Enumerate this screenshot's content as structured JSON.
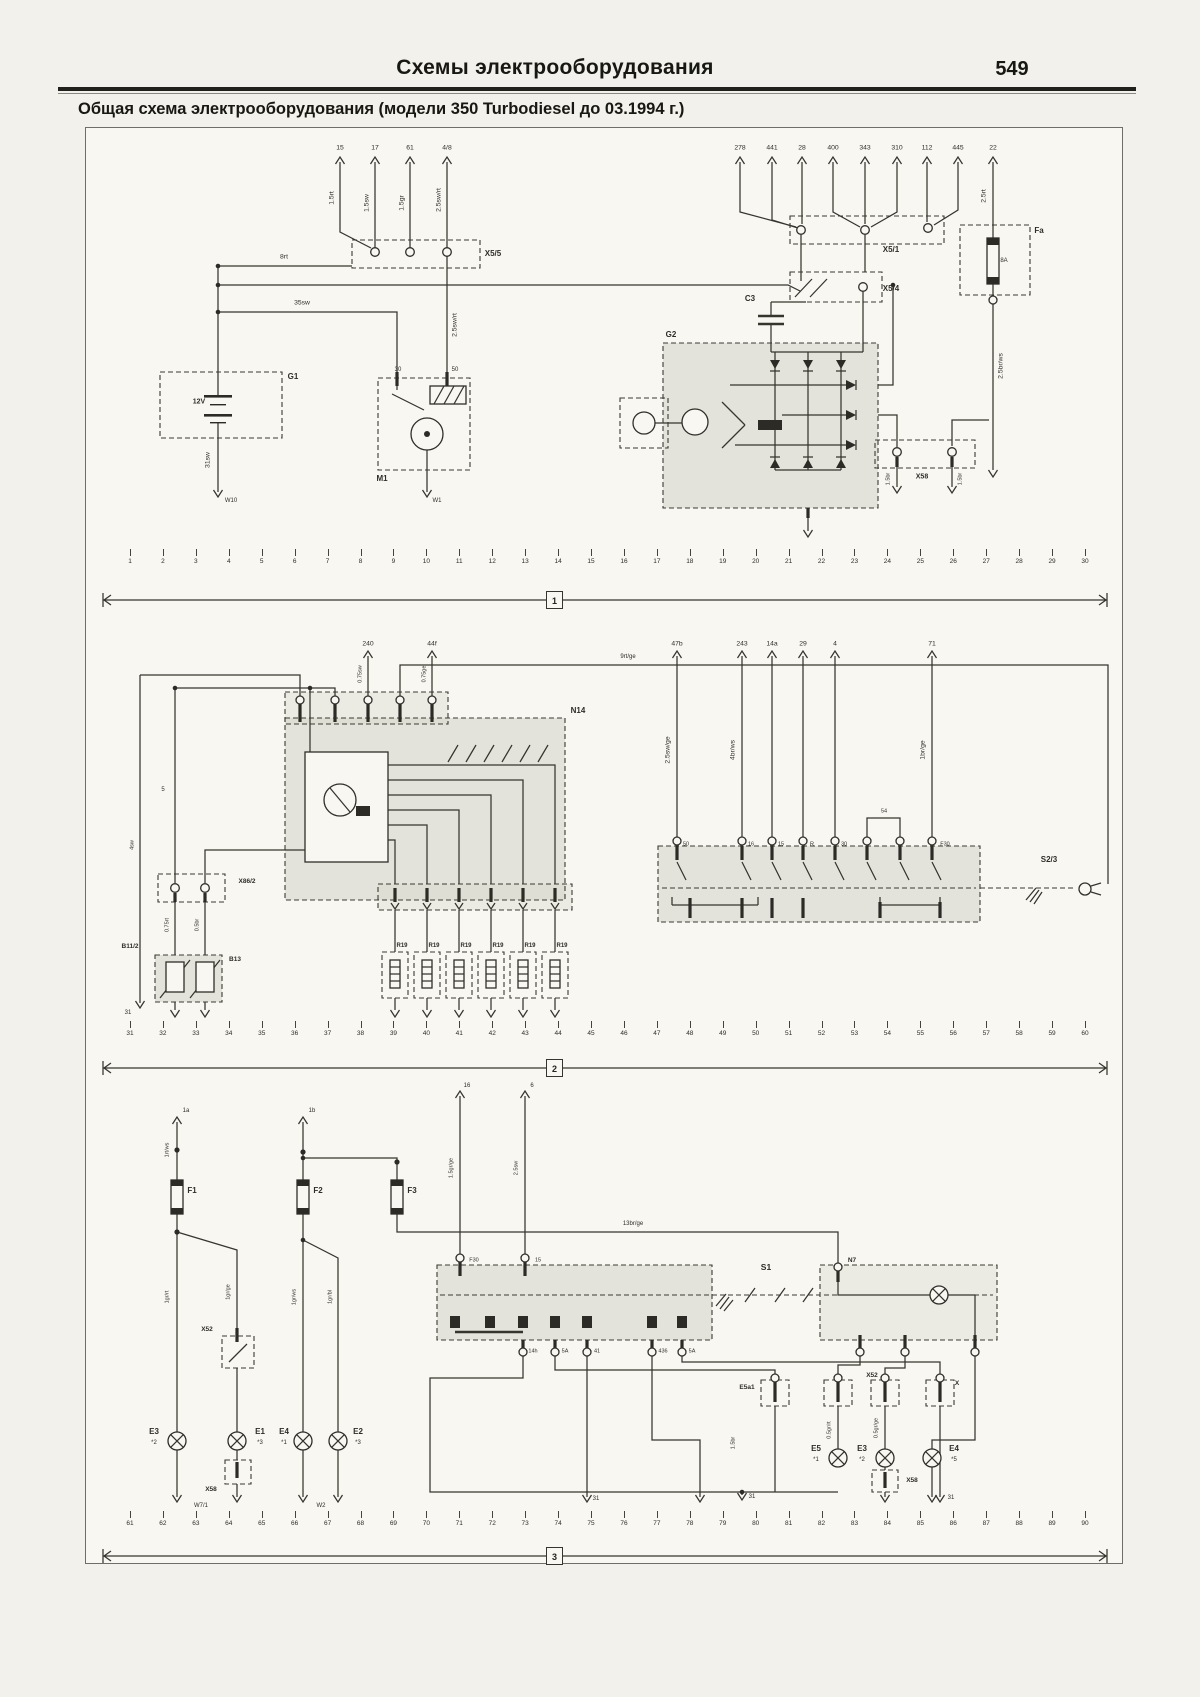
{
  "page": {
    "title": "Схемы электрооборудования",
    "page_number": "549",
    "subtitle": "Общая схема электрооборудования (модели 350 Turbodiesel до 03.1994 г.)"
  },
  "sections": [
    {
      "marker": "1"
    },
    {
      "marker": "2"
    },
    {
      "marker": "3"
    }
  ],
  "bus_strips": {
    "bus1": [
      "1",
      "2",
      "3",
      "4",
      "5",
      "6",
      "7",
      "8",
      "9",
      "10",
      "11",
      "12",
      "13",
      "14",
      "15",
      "16",
      "17",
      "18",
      "19",
      "20",
      "21",
      "22",
      "23",
      "24",
      "25",
      "26",
      "27",
      "28",
      "29",
      "30"
    ],
    "bus2": [
      "31",
      "32",
      "33",
      "34",
      "35",
      "36",
      "37",
      "38",
      "39",
      "40",
      "41",
      "42",
      "43",
      "44",
      "45",
      "46",
      "47",
      "48",
      "49",
      "50",
      "51",
      "52",
      "53",
      "54",
      "55",
      "56",
      "57",
      "58",
      "59",
      "60"
    ],
    "bus3": [
      "61",
      "62",
      "63",
      "64",
      "65",
      "66",
      "67",
      "68",
      "69",
      "70",
      "71",
      "72",
      "73",
      "74",
      "75",
      "76",
      "77",
      "78",
      "79",
      "80",
      "81",
      "82",
      "83",
      "84",
      "85",
      "86",
      "87",
      "88",
      "89",
      "90"
    ]
  },
  "diagram": {
    "labels": [
      {
        "n": "ref",
        "t": "15",
        "x": 340,
        "y": 149
      },
      {
        "n": "ref",
        "t": "17",
        "x": 375,
        "y": 149
      },
      {
        "n": "ref",
        "t": "61",
        "x": 410,
        "y": 149
      },
      {
        "n": "ref",
        "t": "4/8",
        "x": 447,
        "y": 149
      },
      {
        "n": "wire",
        "t": "1.5rt",
        "x": 333,
        "y": 198,
        "r": 1
      },
      {
        "n": "wire",
        "t": "1.5sw",
        "x": 368,
        "y": 203,
        "r": 1
      },
      {
        "n": "wire",
        "t": "1.5gr",
        "x": 403,
        "y": 203,
        "r": 1
      },
      {
        "n": "wire",
        "t": "2.5sw/rt",
        "x": 440,
        "y": 200,
        "r": 1
      },
      {
        "n": "comp",
        "t": "X5/5",
        "x": 493,
        "y": 254,
        "b": 1
      },
      {
        "n": "wire",
        "t": "8rt",
        "x": 284,
        "y": 258
      },
      {
        "n": "wire",
        "t": "35sw",
        "x": 302,
        "y": 304
      },
      {
        "n": "wire",
        "t": "2.5sw/rt",
        "x": 456,
        "y": 325,
        "r": 1
      },
      {
        "n": "comp",
        "t": "G1",
        "x": 293,
        "y": 377,
        "b": 1
      },
      {
        "t": "12V",
        "x": 199,
        "y": 402,
        "b": 1,
        "s": 7
      },
      {
        "n": "wire",
        "t": "31sw",
        "x": 209,
        "y": 460,
        "r": 1
      },
      {
        "n": "ground",
        "t": "W10",
        "x": 231,
        "y": 501,
        "s": 6
      },
      {
        "n": "pin",
        "t": "30",
        "x": 398,
        "y": 370,
        "s": 6
      },
      {
        "n": "pin",
        "t": "50",
        "x": 455,
        "y": 370,
        "s": 6
      },
      {
        "n": "comp",
        "t": "M1",
        "x": 382,
        "y": 479,
        "b": 1
      },
      {
        "n": "ground",
        "t": "W1",
        "x": 437,
        "y": 501,
        "s": 6
      },
      {
        "n": "ref",
        "t": "278",
        "x": 740,
        "y": 149
      },
      {
        "n": "ref",
        "t": "441",
        "x": 772,
        "y": 149
      },
      {
        "n": "ref",
        "t": "28",
        "x": 802,
        "y": 149
      },
      {
        "n": "ref",
        "t": "400",
        "x": 833,
        "y": 149
      },
      {
        "n": "ref",
        "t": "343",
        "x": 865,
        "y": 149
      },
      {
        "n": "ref",
        "t": "310",
        "x": 897,
        "y": 149
      },
      {
        "n": "ref",
        "t": "112",
        "x": 927,
        "y": 149
      },
      {
        "n": "ref",
        "t": "445",
        "x": 958,
        "y": 149
      },
      {
        "n": "ref",
        "t": "22",
        "x": 993,
        "y": 149
      },
      {
        "n": "wire",
        "t": "2.5rt",
        "x": 985,
        "y": 196,
        "r": 1
      },
      {
        "n": "comp",
        "t": "X5/1",
        "x": 891,
        "y": 250,
        "b": 1
      },
      {
        "n": "comp",
        "t": "X5/4",
        "x": 891,
        "y": 289,
        "b": 1
      },
      {
        "n": "comp",
        "t": "Fa",
        "x": 1039,
        "y": 231,
        "b": 1
      },
      {
        "t": "8A",
        "x": 1004,
        "y": 261,
        "s": 6
      },
      {
        "n": "wire",
        "t": "2.5br/ws",
        "x": 1002,
        "y": 366,
        "r": 1
      },
      {
        "n": "comp",
        "t": "C3",
        "x": 750,
        "y": 299,
        "b": 1
      },
      {
        "n": "comp",
        "t": "G2",
        "x": 671,
        "y": 335,
        "b": 1
      },
      {
        "n": "comp",
        "t": "X58",
        "x": 922,
        "y": 477,
        "b": 1,
        "s": 7
      },
      {
        "n": "wire",
        "t": "1.5br",
        "x": 889,
        "y": 479,
        "r": 1,
        "s": 5.5
      },
      {
        "n": "wire",
        "t": "1.5br",
        "x": 961,
        "y": 479,
        "r": 1,
        "s": 5.5
      },
      {
        "n": "ref",
        "t": "240",
        "x": 368,
        "y": 645
      },
      {
        "n": "ref",
        "t": "44f",
        "x": 432,
        "y": 645
      },
      {
        "n": "wire",
        "t": "0.75sw",
        "x": 361,
        "y": 674,
        "r": 1,
        "s": 5.5
      },
      {
        "n": "wire",
        "t": "0.75ge",
        "x": 425,
        "y": 674,
        "r": 1,
        "s": 5.5
      },
      {
        "n": "wire",
        "t": "9rt/ge",
        "x": 628,
        "y": 657,
        "s": 6
      },
      {
        "n": "comp",
        "t": "N14",
        "x": 578,
        "y": 711,
        "b": 1
      },
      {
        "t": "5",
        "x": 163,
        "y": 790,
        "s": 6
      },
      {
        "n": "wire",
        "t": "4sw",
        "x": 133,
        "y": 845,
        "r": 1,
        "s": 5.5
      },
      {
        "n": "comp",
        "t": "X86/2",
        "x": 247,
        "y": 882,
        "b": 1,
        "s": 6.5
      },
      {
        "n": "wire",
        "t": "0.75rt",
        "x": 168,
        "y": 925,
        "r": 1,
        "s": 5.5
      },
      {
        "n": "wire",
        "t": "0.5br",
        "x": 198,
        "y": 925,
        "r": 1,
        "s": 5.5
      },
      {
        "n": "comp",
        "t": "B11/2",
        "x": 130,
        "y": 947,
        "b": 1,
        "s": 6.5
      },
      {
        "n": "comp",
        "t": "B13",
        "x": 235,
        "y": 960,
        "b": 1,
        "s": 6.5
      },
      {
        "n": "ground",
        "t": "31",
        "x": 128,
        "y": 1013,
        "s": 6
      },
      {
        "n": "comp",
        "t": "R19",
        "x": 402,
        "y": 946,
        "b": 1,
        "s": 6
      },
      {
        "n": "comp",
        "t": "R19",
        "x": 434,
        "y": 946,
        "b": 1,
        "s": 6
      },
      {
        "n": "comp",
        "t": "R19",
        "x": 466,
        "y": 946,
        "b": 1,
        "s": 6
      },
      {
        "n": "comp",
        "t": "R19",
        "x": 498,
        "y": 946,
        "b": 1,
        "s": 6
      },
      {
        "n": "comp",
        "t": "R19",
        "x": 530,
        "y": 946,
        "b": 1,
        "s": 6
      },
      {
        "n": "comp",
        "t": "R19",
        "x": 562,
        "y": 946,
        "b": 1,
        "s": 6
      },
      {
        "n": "ref",
        "t": "47b",
        "x": 677,
        "y": 645
      },
      {
        "n": "ref",
        "t": "243",
        "x": 742,
        "y": 645
      },
      {
        "n": "ref",
        "t": "14a",
        "x": 772,
        "y": 645
      },
      {
        "n": "ref",
        "t": "29",
        "x": 803,
        "y": 645
      },
      {
        "n": "ref",
        "t": "4",
        "x": 835,
        "y": 645
      },
      {
        "n": "ref",
        "t": "71",
        "x": 932,
        "y": 645
      },
      {
        "n": "wire",
        "t": "2.5sw/ge",
        "x": 669,
        "y": 750,
        "r": 1
      },
      {
        "n": "wire",
        "t": "4br/ws",
        "x": 734,
        "y": 750,
        "r": 1
      },
      {
        "n": "wire",
        "t": "1br/ge",
        "x": 924,
        "y": 750,
        "r": 1
      },
      {
        "t": "54",
        "x": 884,
        "y": 812,
        "s": 5.5
      },
      {
        "n": "pin",
        "t": "50",
        "x": 686,
        "y": 845,
        "s": 5.5
      },
      {
        "n": "pin",
        "t": "16",
        "x": 751,
        "y": 845,
        "s": 5.5
      },
      {
        "n": "pin",
        "t": "15",
        "x": 781,
        "y": 845,
        "s": 5.5
      },
      {
        "n": "pin",
        "t": "R",
        "x": 812,
        "y": 845,
        "s": 5.5
      },
      {
        "n": "pin",
        "t": "30",
        "x": 844,
        "y": 845,
        "s": 5.5
      },
      {
        "n": "pin",
        "t": "F30",
        "x": 945,
        "y": 845,
        "s": 5.5
      },
      {
        "n": "comp",
        "t": "S2/3",
        "x": 1049,
        "y": 860,
        "b": 1
      },
      {
        "n": "ref",
        "t": "1a",
        "x": 186,
        "y": 1111,
        "s": 6
      },
      {
        "n": "ref",
        "t": "1b",
        "x": 312,
        "y": 1111,
        "s": 6
      },
      {
        "n": "ref",
        "t": "16",
        "x": 467,
        "y": 1086,
        "s": 6
      },
      {
        "n": "ref",
        "t": "6",
        "x": 532,
        "y": 1086,
        "s": 6
      },
      {
        "n": "wire",
        "t": "1rt/ws",
        "x": 168,
        "y": 1150,
        "r": 1,
        "s": 5.5
      },
      {
        "n": "comp",
        "t": "F1",
        "x": 192,
        "y": 1191,
        "b": 1
      },
      {
        "n": "comp",
        "t": "F2",
        "x": 318,
        "y": 1191,
        "b": 1
      },
      {
        "n": "comp",
        "t": "F3",
        "x": 412,
        "y": 1191,
        "b": 1
      },
      {
        "n": "wire",
        "t": "1gr/rt",
        "x": 168,
        "y": 1297,
        "r": 1,
        "s": 5.5
      },
      {
        "n": "wire",
        "t": "1gr/ge",
        "x": 229,
        "y": 1292,
        "r": 1,
        "s": 5.5
      },
      {
        "n": "wire",
        "t": "1gr/ws",
        "x": 295,
        "y": 1297,
        "r": 1,
        "s": 5.5
      },
      {
        "n": "wire",
        "t": "1gr/bl",
        "x": 331,
        "y": 1297,
        "r": 1,
        "s": 5.5
      },
      {
        "n": "wire",
        "t": "1.5gr/ge",
        "x": 452,
        "y": 1168,
        "r": 1,
        "s": 5.5
      },
      {
        "n": "wire",
        "t": "2.5sw",
        "x": 517,
        "y": 1168,
        "r": 1,
        "s": 5.5
      },
      {
        "n": "wire",
        "t": "13br/ge",
        "x": 633,
        "y": 1224,
        "s": 6
      },
      {
        "n": "pin",
        "t": "N7",
        "x": 852,
        "y": 1261,
        "b": 1,
        "s": 6.5
      },
      {
        "n": "comp",
        "t": "S1",
        "x": 766,
        "y": 1267,
        "b": 1,
        "s": 8.5
      },
      {
        "n": "pin",
        "t": "F30",
        "x": 474,
        "y": 1261,
        "s": 5.5
      },
      {
        "n": "pin",
        "t": "15",
        "x": 538,
        "y": 1261,
        "s": 5.5
      },
      {
        "n": "pin",
        "t": "14h",
        "x": 533,
        "y": 1352,
        "s": 5.5
      },
      {
        "n": "pin",
        "t": "5A",
        "x": 565,
        "y": 1352,
        "s": 5.5
      },
      {
        "n": "pin",
        "t": "41",
        "x": 597,
        "y": 1352,
        "s": 5.5
      },
      {
        "n": "pin",
        "t": "436",
        "x": 663,
        "y": 1352,
        "s": 5.5
      },
      {
        "n": "pin",
        "t": "5A",
        "x": 692,
        "y": 1352,
        "s": 5.5
      },
      {
        "n": "comp",
        "t": "X52",
        "x": 207,
        "y": 1330,
        "b": 1,
        "s": 6.5
      },
      {
        "n": "comp",
        "t": "X58",
        "x": 211,
        "y": 1490,
        "b": 1,
        "s": 6.5
      },
      {
        "n": "comp",
        "t": "E3",
        "x": 154,
        "y": 1432,
        "b": 1
      },
      {
        "t": "*2",
        "x": 154,
        "y": 1443,
        "s": 6
      },
      {
        "n": "comp",
        "t": "E1",
        "x": 260,
        "y": 1432,
        "b": 1
      },
      {
        "t": "*3",
        "x": 260,
        "y": 1443,
        "s": 6
      },
      {
        "n": "comp",
        "t": "E4",
        "x": 284,
        "y": 1432,
        "b": 1
      },
      {
        "t": "*1",
        "x": 284,
        "y": 1443,
        "s": 6
      },
      {
        "n": "comp",
        "t": "E2",
        "x": 358,
        "y": 1432,
        "b": 1
      },
      {
        "t": "*3",
        "x": 358,
        "y": 1443,
        "s": 6
      },
      {
        "n": "ground",
        "t": "W7/1",
        "x": 201,
        "y": 1506,
        "s": 6
      },
      {
        "n": "ground",
        "t": "W2",
        "x": 321,
        "y": 1506,
        "s": 6
      },
      {
        "n": "comp",
        "t": "E5a1",
        "x": 747,
        "y": 1388,
        "b": 1,
        "s": 6.5
      },
      {
        "n": "comp",
        "t": "X52",
        "x": 872,
        "y": 1376,
        "b": 1,
        "s": 6.5
      },
      {
        "n": "comp",
        "t": "X",
        "x": 957,
        "y": 1384,
        "b": 1,
        "s": 6.5
      },
      {
        "n": "comp",
        "t": "X58",
        "x": 912,
        "y": 1481,
        "b": 1,
        "s": 6.5
      },
      {
        "n": "comp",
        "t": "E5",
        "x": 816,
        "y": 1449,
        "b": 1
      },
      {
        "t": "*1",
        "x": 816,
        "y": 1460,
        "s": 6
      },
      {
        "n": "comp",
        "t": "E3",
        "x": 862,
        "y": 1449,
        "b": 1
      },
      {
        "t": "*2",
        "x": 862,
        "y": 1460,
        "s": 6
      },
      {
        "n": "comp",
        "t": "E4",
        "x": 954,
        "y": 1449,
        "b": 1
      },
      {
        "t": "*5",
        "x": 954,
        "y": 1460,
        "s": 6
      },
      {
        "n": "wire",
        "t": "1.5br",
        "x": 734,
        "y": 1443,
        "r": 1,
        "s": 5.5
      },
      {
        "n": "wire",
        "t": "0.5gr/rt",
        "x": 830,
        "y": 1430,
        "r": 1,
        "s": 5.5
      },
      {
        "n": "wire",
        "t": "0.5gr/ge",
        "x": 877,
        "y": 1428,
        "r": 1,
        "s": 5.5
      },
      {
        "n": "ground",
        "t": "31",
        "x": 596,
        "y": 1499,
        "s": 6
      },
      {
        "n": "ground",
        "t": "31",
        "x": 752,
        "y": 1497,
        "s": 6
      },
      {
        "n": "ground",
        "t": "31",
        "x": 951,
        "y": 1498,
        "s": 6
      }
    ]
  }
}
